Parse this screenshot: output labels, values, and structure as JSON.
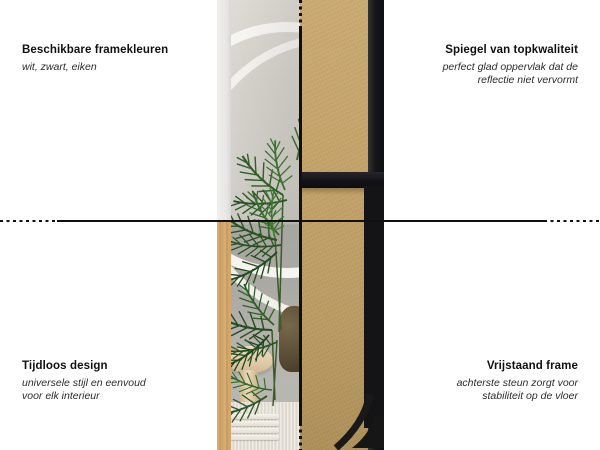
{
  "page": {
    "background": "#ffffff"
  },
  "callouts": {
    "top_left": {
      "title": "Beschikbare framekleuren",
      "subtitle_lines": [
        "wit, zwart, eiken"
      ]
    },
    "top_right": {
      "title": "Spiegel van topkwaliteit",
      "subtitle_lines": [
        "perfect glad oppervlak dat de",
        "reflectie niet vervormt"
      ]
    },
    "bottom_left": {
      "title": "Tijdloos design",
      "subtitle_lines": [
        "universele stijl en eenvoud",
        "voor elk interieur"
      ]
    },
    "bottom_right": {
      "title": "Vrijstaand frame",
      "subtitle_lines": [
        "achterste steun zorgt voor",
        "stabiliteit op de vloer"
      ]
    }
  },
  "product_views": {
    "front": {
      "description": "front of free-standing mirror reflecting a palm plant, stool and interior",
      "frame_color_top": "white",
      "frame_color_bottom": "oak"
    },
    "back": {
      "description": "back of mirror showing MDF panel, black frame and fold-out support leg",
      "frame_color": "black"
    }
  },
  "colors": {
    "line": "#101010",
    "mdf": "#c2a169",
    "black_frame": "#161616",
    "white_frame": "#ebeae8",
    "oak_frame": "#d3a76b",
    "wall_reflection": "#cecbc5",
    "plant_green": "#2f5e26"
  }
}
